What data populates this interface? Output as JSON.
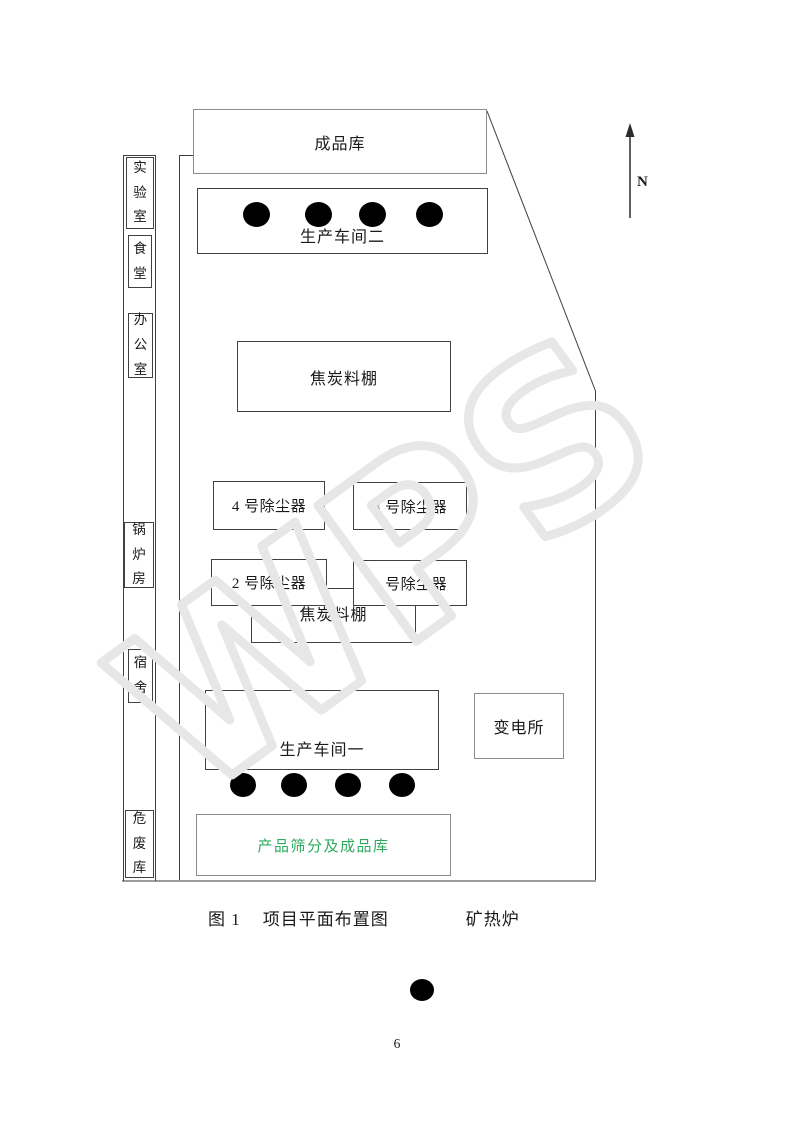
{
  "page_number": "6",
  "caption": {
    "prefix": "图 1",
    "title": "项目平面布置图",
    "legend_label": "矿热炉"
  },
  "compass": {
    "label": "N"
  },
  "watermark": {
    "text": "WPS",
    "color": "#e7e7e7"
  },
  "colors": {
    "screening_label_green": "#2cab5e",
    "line_dark": "#404040",
    "line_gray": "#8c8c8c"
  },
  "site": {
    "left_strip": [
      {
        "label": "实验室"
      },
      {
        "label": "食堂"
      },
      {
        "label": "办公室"
      },
      {
        "label": "锅炉房"
      },
      {
        "label": "宿舍"
      },
      {
        "label": "危废库"
      }
    ],
    "buildings": {
      "finished_warehouse": {
        "label": "成品库"
      },
      "workshop2": {
        "label": "生产车间二",
        "furnace_count": 4
      },
      "coke_shed_upper": {
        "label": "焦炭料棚"
      },
      "dust4": {
        "label": "4 号除尘器"
      },
      "dust3": {
        "label": "3 号除尘器"
      },
      "dust2": {
        "label": "2 号除尘器"
      },
      "dust1": {
        "label": "1 号除尘器"
      },
      "coke_shed_lower": {
        "label": "焦炭料棚"
      },
      "workshop1": {
        "label": "生产车间一",
        "furnace_count": 4
      },
      "substation": {
        "label": "变电所"
      },
      "screening_warehouse": {
        "label": "产品筛分及成品库",
        "label_color": "#2cab5e"
      }
    }
  }
}
